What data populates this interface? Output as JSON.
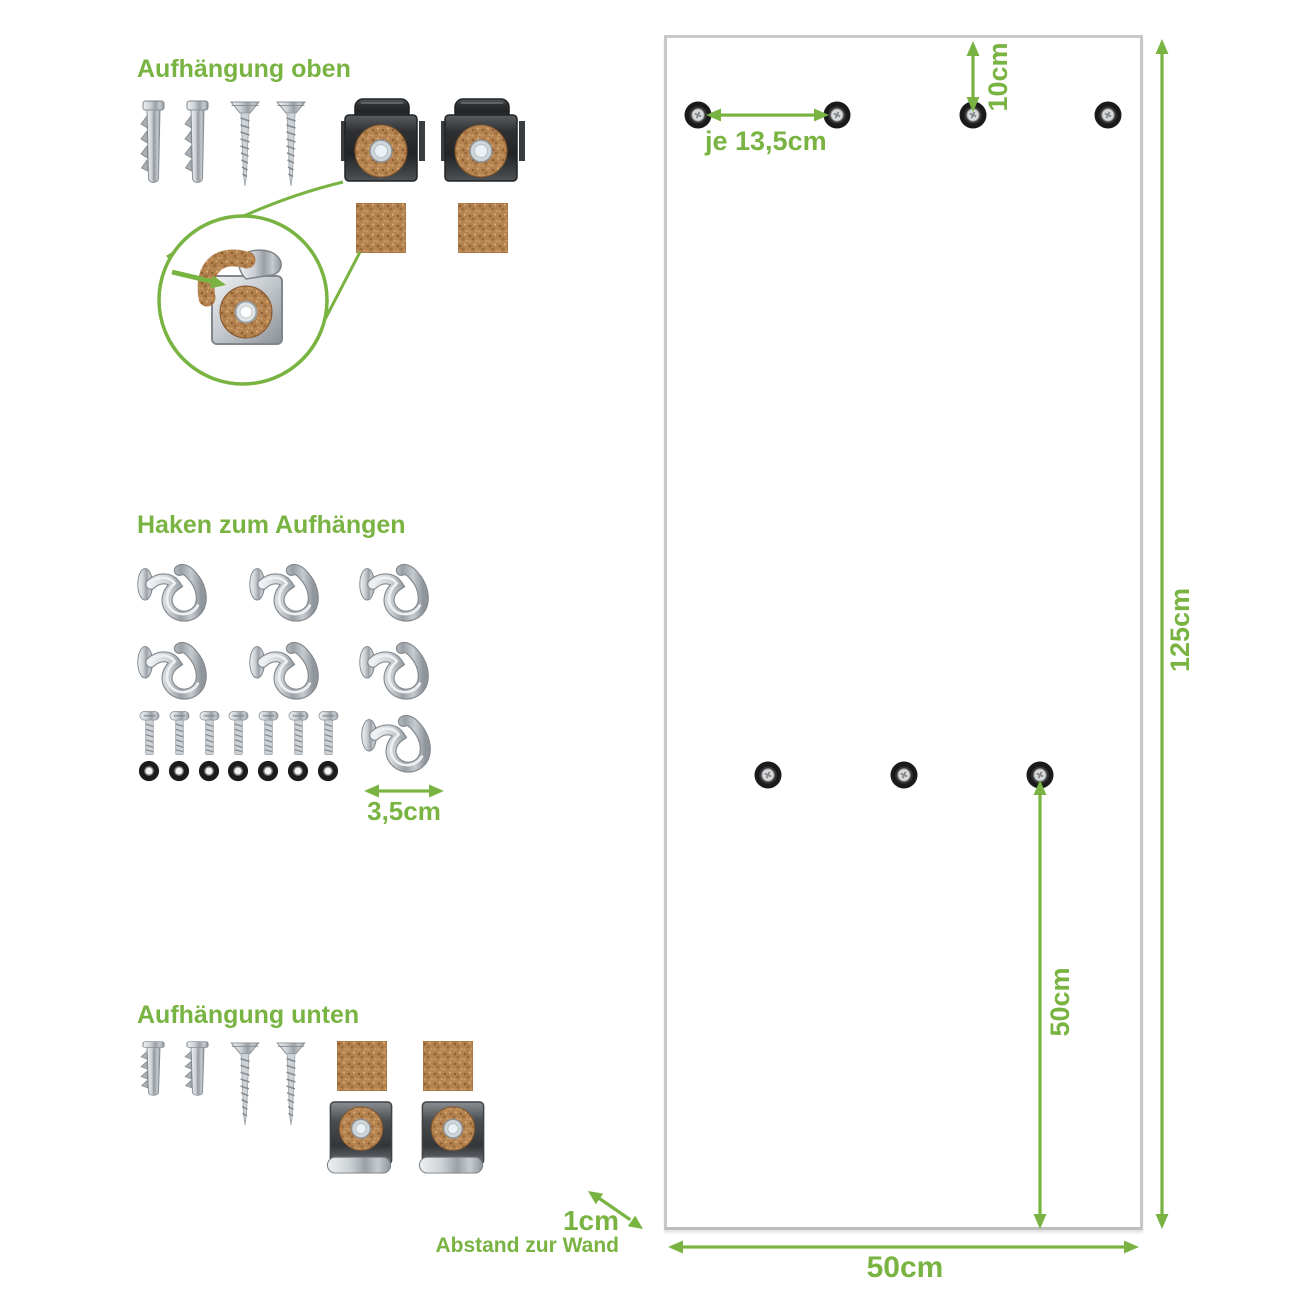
{
  "colors": {
    "accent_green": "#79b342",
    "panel_border": "#c8c8c8",
    "cork_brown": "#b5834f",
    "metal_dark": "#2e3032"
  },
  "sections": {
    "top_mount": {
      "heading": "Aufhängung oben"
    },
    "hooks": {
      "heading": "Haken zum Aufhängen",
      "width_label": "3,5cm"
    },
    "bottom_mount": {
      "heading": "Aufhängung unten"
    }
  },
  "panel": {
    "hole_spacing_label": "je 13,5cm",
    "top_offset_label": "10cm",
    "height_label": "125cm",
    "bottom_hole_offset_label": "50cm",
    "width_label": "50cm",
    "wall_distance_value": "1cm",
    "wall_distance_caption": "Abstand zur Wand",
    "holes_top_row": 4,
    "holes_middle_row": 3
  },
  "hardware": {
    "top_mount": {
      "wall_plugs": 2,
      "wood_screws": 2,
      "clips": 2,
      "cork_pads": 2
    },
    "hooks": {
      "hooks": 7,
      "machine_screws": 7,
      "washers": 7
    },
    "bottom_mount": {
      "wall_plugs": 2,
      "wood_screws": 2,
      "clips": 2,
      "cork_pads": 2
    }
  }
}
